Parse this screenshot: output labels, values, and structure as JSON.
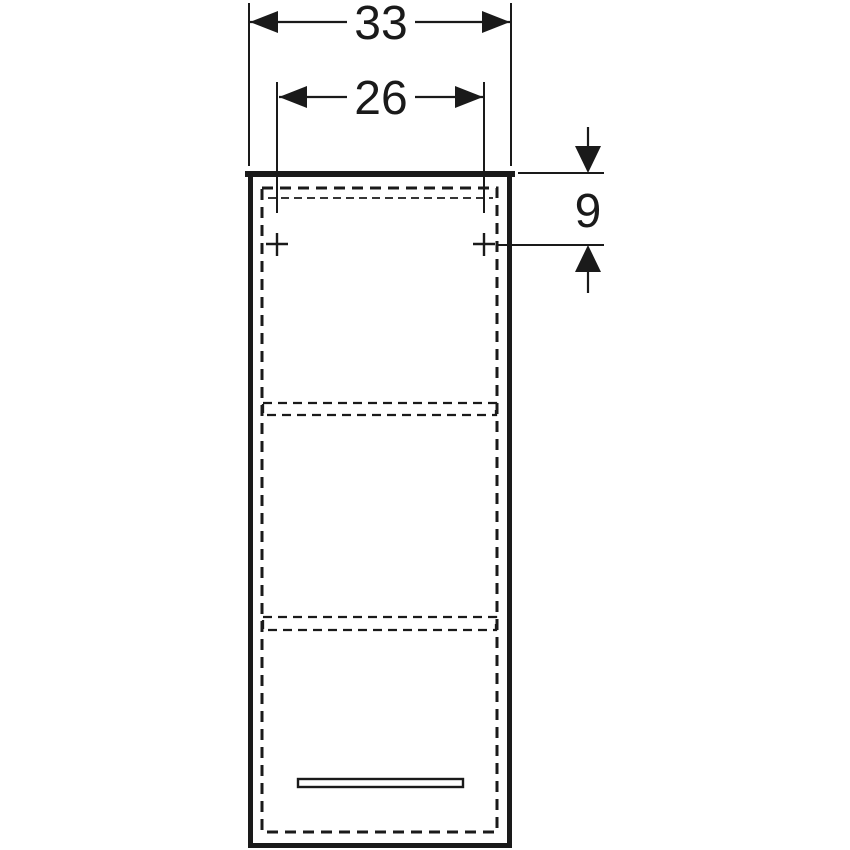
{
  "drawing": {
    "subject": "wall-cabinet-front-elevation-technical-drawing",
    "colors": {
      "line": "#1a1a1a",
      "background": "#ffffff"
    },
    "dimensions": [
      {
        "id": "overall-width",
        "label": "33"
      },
      {
        "id": "fixing-hole-spacing",
        "label": "26"
      },
      {
        "id": "fixing-hole-offset-from-top",
        "label": "9"
      }
    ]
  }
}
